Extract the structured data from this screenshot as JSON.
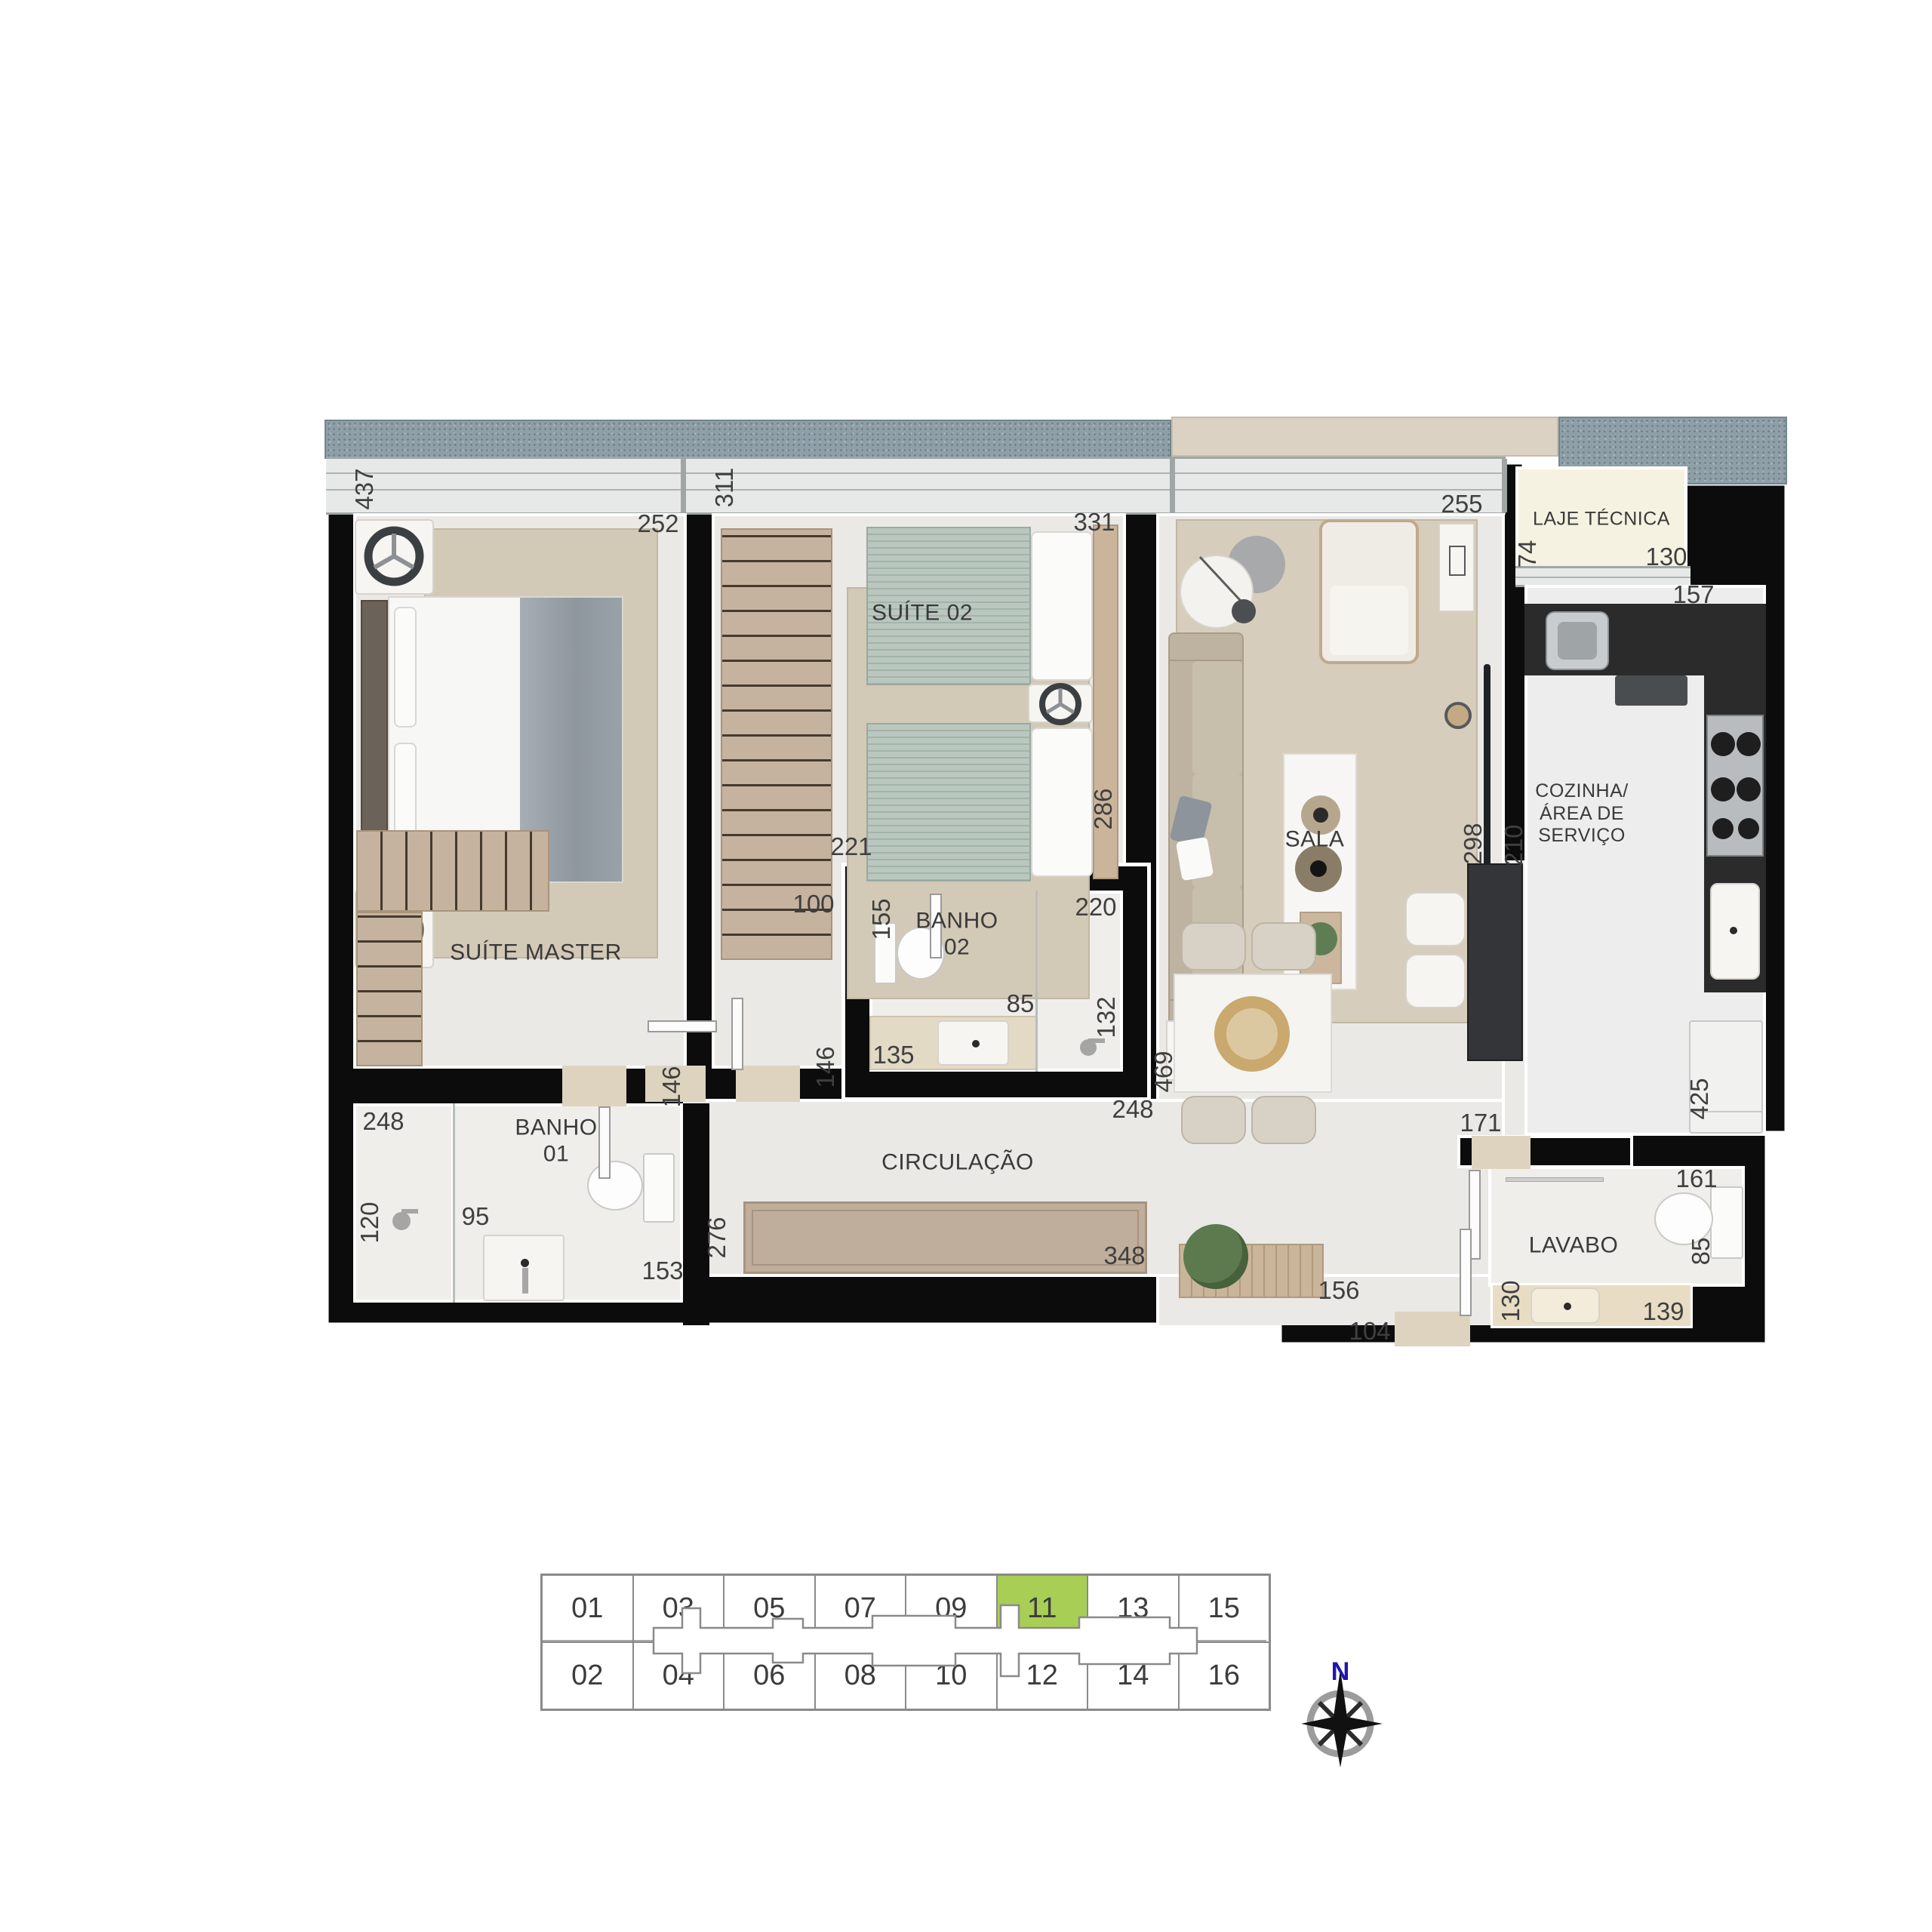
{
  "plan": {
    "rooms": {
      "suite_master": "SUÍTE MASTER",
      "suite_02": "SUÍTE 02",
      "banho_02": "BANHO\n02",
      "banho_01": "BANHO\n01",
      "sala": "SALA",
      "cozinha": "COZINHA/\nÁREA DE\nSERVIÇO",
      "lavabo": "LAVABO",
      "laje_tecnica": "LAJE TÉCNICA",
      "circulacao": "CIRCULAÇÃO"
    },
    "dims": {
      "suite_master_left": "437",
      "suite_master_top": "252",
      "suite_02_left": "311",
      "suite_02_top": "331",
      "sala_top": "255",
      "laje_left": "74",
      "laje_bottom": "130",
      "kitchen_counter": "157",
      "suite_02_right": "286",
      "banho_02_above": "221",
      "banho_02_left": "155",
      "banho_02_top": "220",
      "banho_02_outside_left": "100",
      "sala_right": "298",
      "cozinha_left": "210",
      "banho_02_sink": "85",
      "banho_02_shower_right": "132",
      "banho_02_bottom_left": "135",
      "banho_02_wall_left": "146",
      "corridor_right": "469",
      "banho_02_bottom": "248",
      "banho_01_top": "248",
      "banho_01_left": "120",
      "banho_01_shower": "95",
      "banho_01_bottom": "153",
      "banho_01_right": "146",
      "sideboard_left": "276",
      "sideboard_right": "348",
      "entry_console": "156",
      "entry_step": "104",
      "lavabo_above": "171",
      "kitchen_right": "425",
      "lavabo_top": "161",
      "lavabo_right": "85",
      "lavabo_sink_left": "130",
      "lavabo_sink_bottom": "139"
    }
  },
  "unit_selector": {
    "top_row": [
      "01",
      "03",
      "05",
      "07",
      "09",
      "11",
      "13",
      "15"
    ],
    "bottom_row": [
      "02",
      "04",
      "06",
      "08",
      "10",
      "12",
      "14",
      "16"
    ],
    "selected_unit": "11",
    "highlight_color": "#a9ce55"
  },
  "compass": {
    "north_label": "N"
  },
  "colors": {
    "wall": "#0c0c0c",
    "floor": "#eae9e6",
    "counter_dark": "#2b2b2b",
    "furniture_tan": "#c6b39f",
    "bed_sage": "#b9c7bf",
    "terrace_speckle": "#8e9fa7",
    "highlight_green": "#a9ce55",
    "compass_north_blue": "#1d16b0"
  }
}
